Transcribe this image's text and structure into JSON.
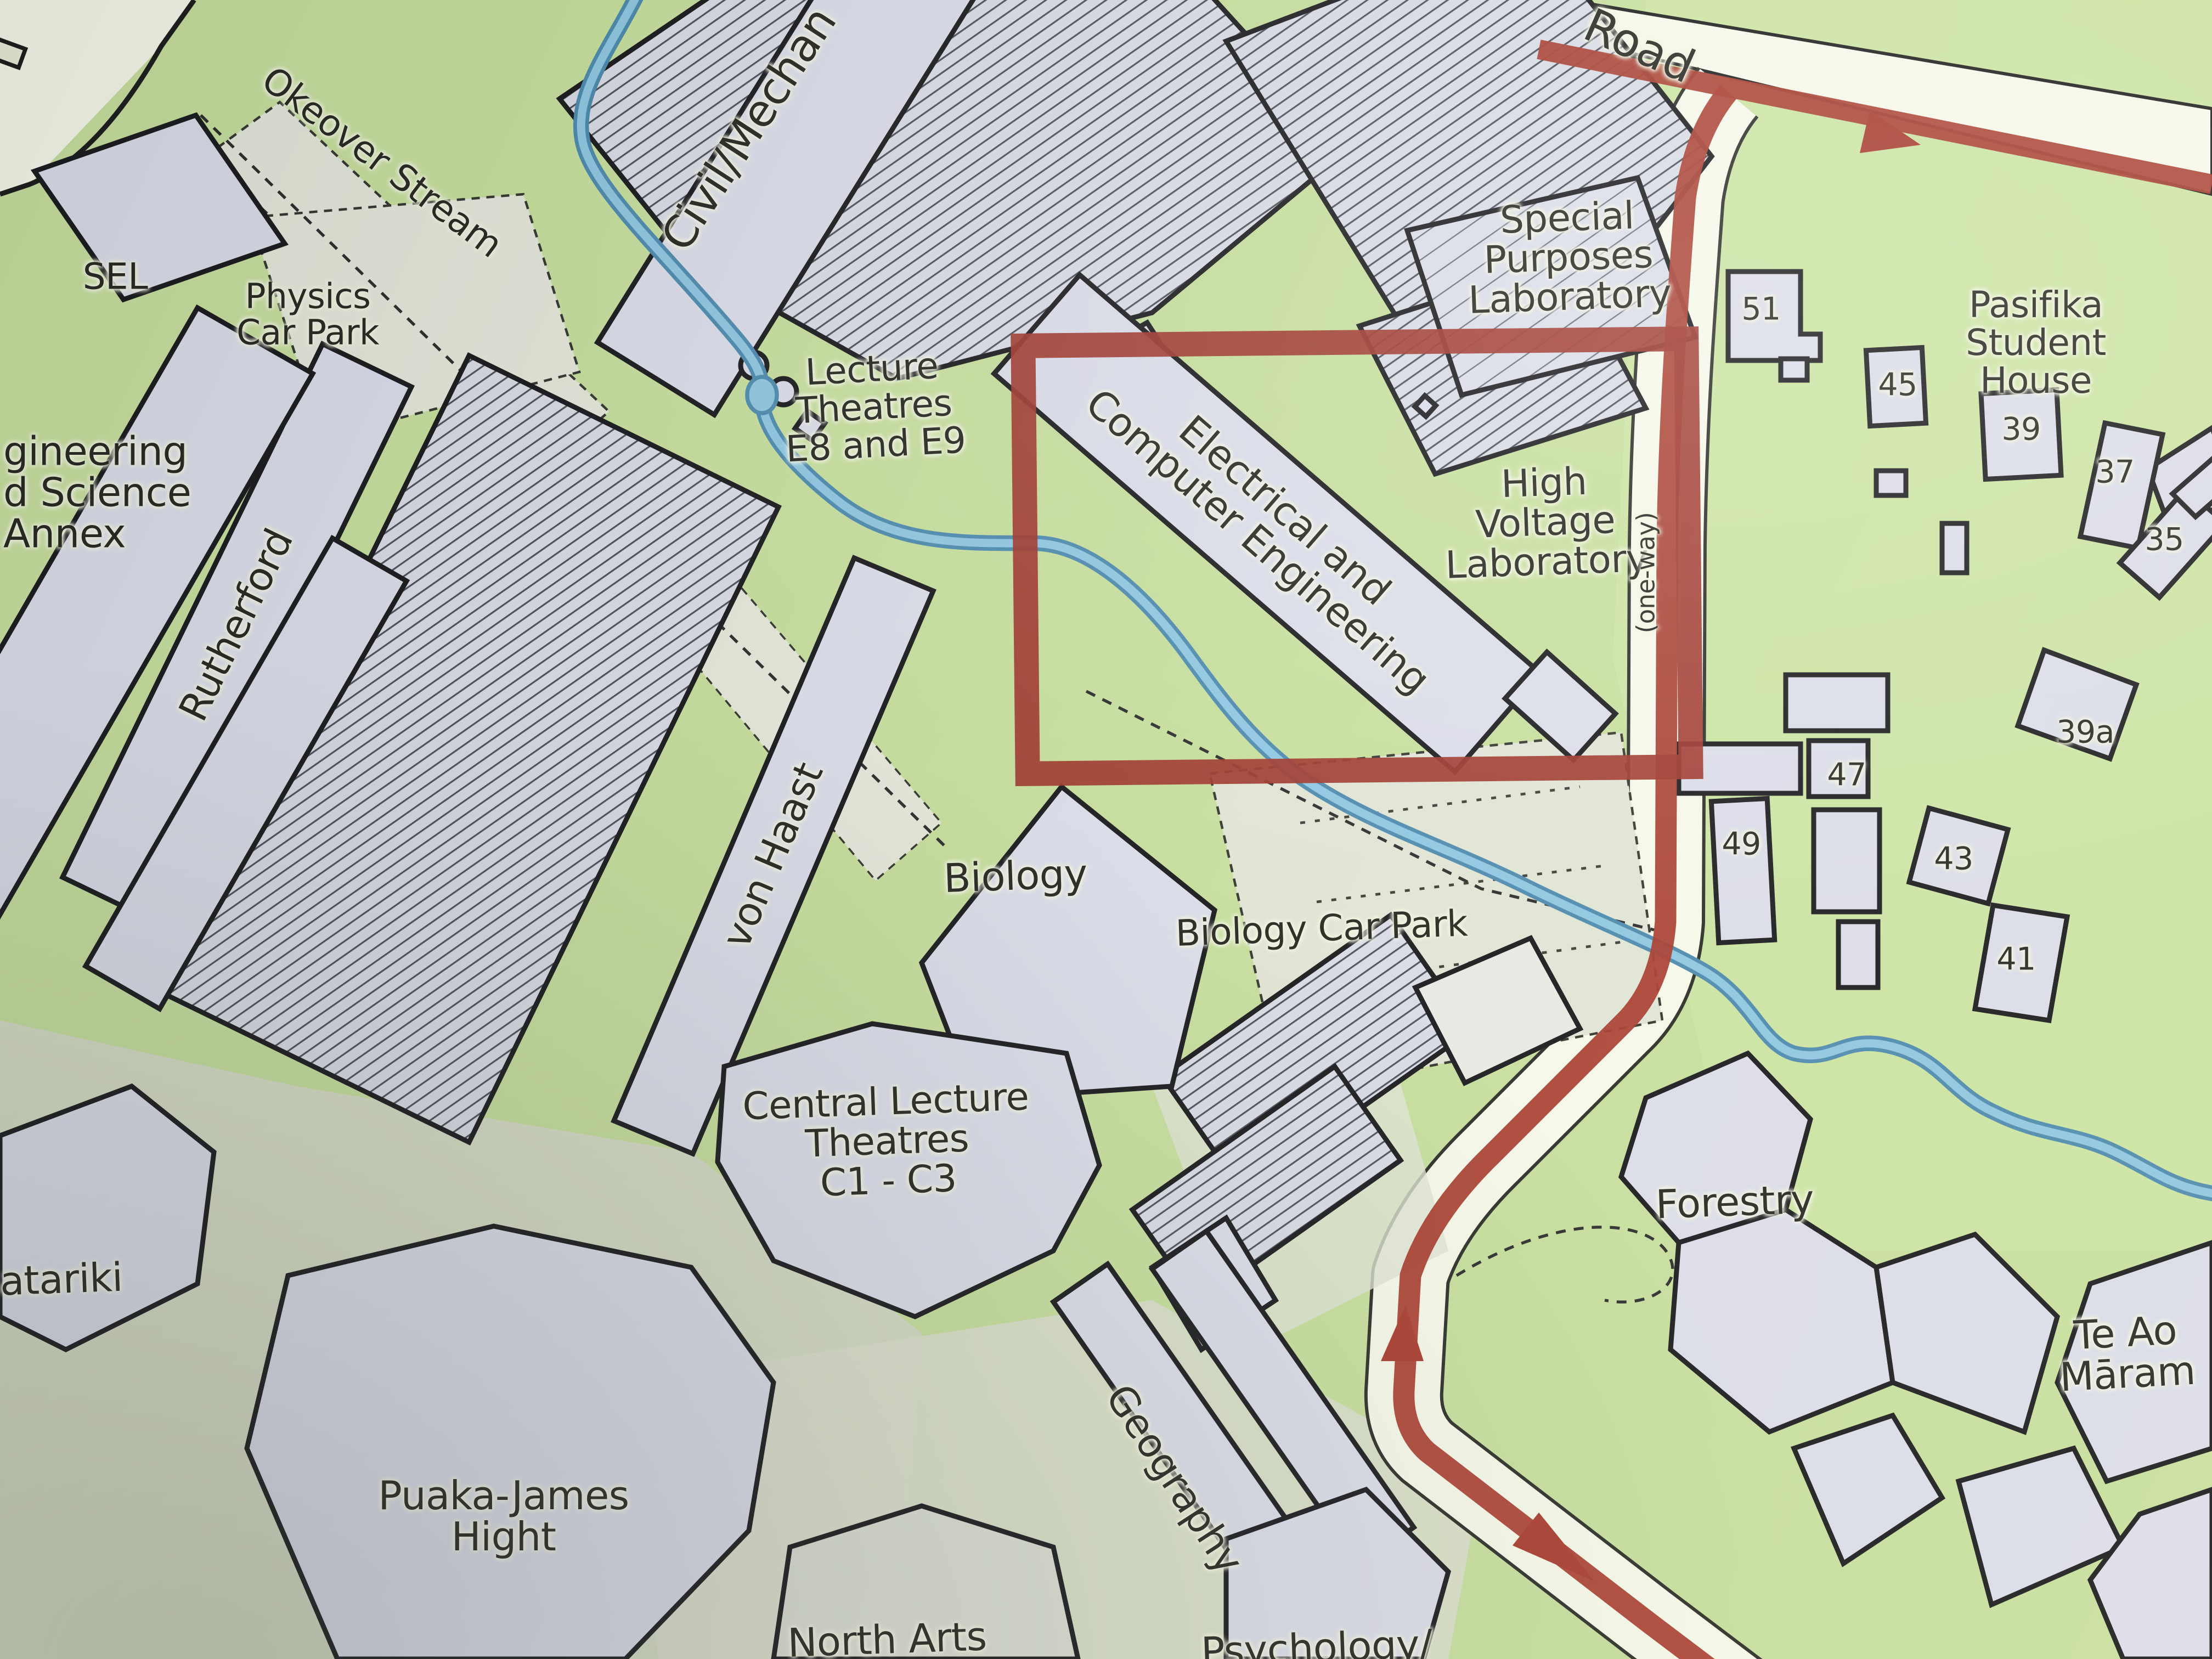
{
  "colors": {
    "paper_road": "#f6f8e9",
    "grass_green": "#c6de9c",
    "grass_green_light": "#cfe7a8",
    "building_fill": "#dadce8",
    "building_outline": "#18181b",
    "plaza_fill": "#e4e7d9",
    "shadow_zone": "#d5dac8",
    "stream_blue": "#8ec6e0",
    "stream_blue_dark": "#4b89ad",
    "route_red": "#a63a2c",
    "highlight_red": "#9d352a",
    "label_ink": "#26261f"
  },
  "labels": {
    "okeover_stream": "Okeover Stream",
    "sel": "SEL",
    "physics_car_park": "Physics\nCar Park",
    "civil_mechanical": "Civil/Mechan",
    "lecture_theatres": "Lecture\nTheatres\nE8 and E9",
    "special_purposes_laboratory": "Special\nPurposes\nLaboratory",
    "road": "Road",
    "pasifika_student_house": "Pasifika Student\nHouse",
    "electrical_computer_engineering": "Electrical and\nComputer Engineering",
    "high_voltage_laboratory": "High\nVoltage\nLaboratory",
    "one_way": "(one-way)",
    "engineering_science_annex": "gineering\nd Science\nAnnex",
    "rutherford": "Rutherford",
    "von_haast": "von Haast",
    "biology": "Biology",
    "biology_car_park": "Biology Car Park",
    "central_lecture_theatres": "Central Lecture\nTheatres\nC1 - C3",
    "forestry": "Forestry",
    "te_ao_marama": "Te Ao\nMāram",
    "geography": "Geography",
    "puaka_james_hight": "Puaka-James\nHight",
    "matariki": "atariki",
    "north_arts": "North Arts",
    "psychology": "Psychology/"
  },
  "house_numbers": {
    "h51": "51",
    "h45": "45",
    "h39": "39",
    "h37": "37",
    "h35": "35",
    "h39a": "39a",
    "h47": "47",
    "h49": "49",
    "h43": "43",
    "h41": "41"
  },
  "icons": {
    "route_arrow": "filled-triangle"
  }
}
